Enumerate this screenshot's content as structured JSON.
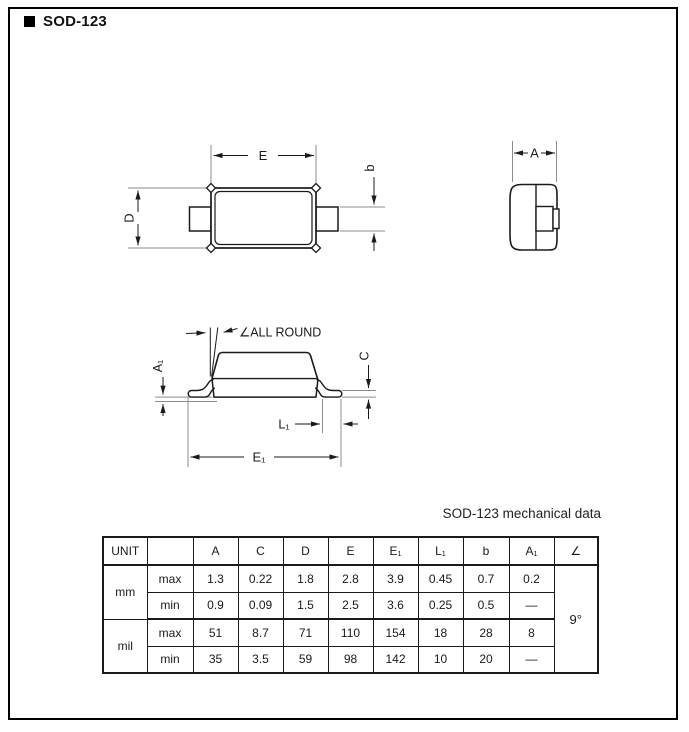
{
  "page": {
    "title": "SOD-123"
  },
  "drawing": {
    "labels": {
      "E": "E",
      "D": "D",
      "b": "b",
      "A": "A",
      "all_round": "∠ALL ROUND",
      "A1": "A₁",
      "C": "C",
      "L1": "L₁",
      "E1": "E₁"
    }
  },
  "table": {
    "title": "SOD-123 mechanical data",
    "headers": [
      "UNIT",
      "",
      "A",
      "C",
      "D",
      "E",
      "E₁",
      "L₁",
      "b",
      "A₁",
      "∠"
    ],
    "units": {
      "mm": "mm",
      "mil": "mil"
    },
    "row_labels": {
      "max": "max",
      "min": "min"
    },
    "rows": {
      "mm_max": [
        "1.3",
        "0.22",
        "1.8",
        "2.8",
        "3.9",
        "0.45",
        "0.7",
        "0.2"
      ],
      "mm_min": [
        "0.9",
        "0.09",
        "1.5",
        "2.5",
        "3.6",
        "0.25",
        "0.5",
        "—"
      ],
      "mil_max": [
        "51",
        "8.7",
        "71",
        "110",
        "154",
        "18",
        "28",
        "8"
      ],
      "mil_min": [
        "35",
        "3.5",
        "59",
        "98",
        "142",
        "10",
        "20",
        "—"
      ]
    },
    "angle": "9°"
  },
  "colors": {
    "outline": "#1b1b1b",
    "extension_line": "#8d8d8d"
  }
}
